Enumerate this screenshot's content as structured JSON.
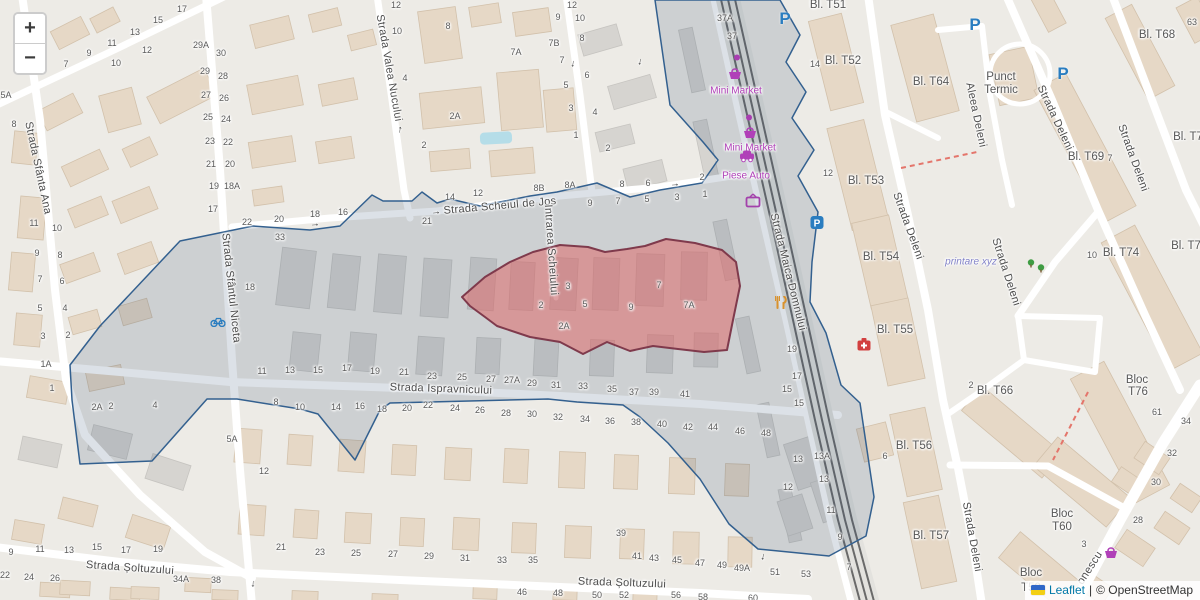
{
  "app": {
    "title": "Leaflet map with highlighted area"
  },
  "controls": {
    "zoom_in": "+",
    "zoom_out": "−"
  },
  "attribution": {
    "flag": "ukraine-flag-icon",
    "leaflet": "Leaflet",
    "separator": "|",
    "copyright": "© OpenStreetMap"
  },
  "colors": {
    "land": "#edebe6",
    "building": "#e6d8c6",
    "building_stroke": "#d2c1ab",
    "building_gray": "#d6d4d0",
    "road": "#ffffff",
    "rail": "#6a6a6a",
    "water": "#b5dde8",
    "parking_blue": "#2a7dc0",
    "poi_purple": "#b040b8",
    "restaurant_orange": "#d9922e",
    "firstaid_red": "#d23f3f",
    "tree_green": "#3f9c43",
    "selected_stroke": "#33608f",
    "selected_fill": "rgba(45,75,115,0.17)",
    "highlight_stroke": "#7f3a4c",
    "highlight_fill": "rgba(222,105,105,0.55)",
    "dashed_path": "#e4756b"
  },
  "street_labels": [
    {
      "t": "Strada Sfânta Ana",
      "x": 38,
      "y": 168,
      "r": 78
    },
    {
      "t": "Strada Valea Nucului",
      "x": 389,
      "y": 68,
      "r": 80
    },
    {
      "t": "Strada Sfântul Niceta",
      "x": 231,
      "y": 288,
      "r": 84
    },
    {
      "t": "Strada Scheiul de Jos",
      "x": 500,
      "y": 206,
      "r": -5
    },
    {
      "t": "Intrarea Scheiului",
      "x": 551,
      "y": 250,
      "r": 86
    },
    {
      "t": "Strada Ispravnicului",
      "x": 441,
      "y": 389,
      "r": 2
    },
    {
      "t": "Strada Șoltuzului",
      "x": 130,
      "y": 568,
      "r": 4
    },
    {
      "t": "Strada Șoltuzului",
      "x": 622,
      "y": 583,
      "r": 2
    },
    {
      "t": "Strada Maica Domnului",
      "x": 788,
      "y": 272,
      "r": 76
    },
    {
      "t": "Aleea Deleni",
      "x": 976,
      "y": 115,
      "r": 78
    },
    {
      "t": "Strada Deleni",
      "x": 1055,
      "y": 118,
      "r": 65
    },
    {
      "t": "Strada Deleni",
      "x": 1133,
      "y": 158,
      "r": 70
    },
    {
      "t": "Strada Deleni",
      "x": 908,
      "y": 226,
      "r": 70
    },
    {
      "t": "Strada Deleni",
      "x": 1006,
      "y": 272,
      "r": 72
    },
    {
      "t": "Strada Deleni",
      "x": 972,
      "y": 537,
      "r": 80
    },
    {
      "t": "onescu",
      "x": 1090,
      "y": 568,
      "r": -57
    }
  ],
  "building_labels": [
    {
      "t": "Bl. T51",
      "x": 828,
      "y": 5
    },
    {
      "t": "Bl. T52",
      "x": 843,
      "y": 61
    },
    {
      "t": "Bl. T53",
      "x": 866,
      "y": 181
    },
    {
      "t": "Bl. T54",
      "x": 881,
      "y": 257
    },
    {
      "t": "Bl. T55",
      "x": 895,
      "y": 330
    },
    {
      "t": "Bl. T56",
      "x": 914,
      "y": 446
    },
    {
      "t": "Bl. T57",
      "x": 931,
      "y": 536
    },
    {
      "t": "Bl. T64",
      "x": 931,
      "y": 82
    },
    {
      "t": "Bl. T66",
      "x": 995,
      "y": 391
    },
    {
      "t": "Bl. T68",
      "x": 1157,
      "y": 35
    },
    {
      "t": "Bl. T69",
      "x": 1086,
      "y": 157
    },
    {
      "t": "Bl. T74",
      "x": 1121,
      "y": 253
    },
    {
      "t": "Bl. T7",
      "x": 1188,
      "y": 137
    },
    {
      "t": "Bl. T7",
      "x": 1186,
      "y": 246
    },
    {
      "t": "Bloc",
      "x": 1137,
      "y": 380
    },
    {
      "t": "T76",
      "x": 1138,
      "y": 392
    },
    {
      "t": "Bloc",
      "x": 1062,
      "y": 514
    },
    {
      "t": "T60",
      "x": 1062,
      "y": 527
    },
    {
      "t": "Bloc",
      "x": 1031,
      "y": 573
    },
    {
      "t": "T59",
      "x": 1031,
      "y": 588
    },
    {
      "t": "Punct",
      "x": 1001,
      "y": 77
    },
    {
      "t": "Termic",
      "x": 1001,
      "y": 90
    }
  ],
  "poi_labels": [
    {
      "t": "Mini Market",
      "x": 736,
      "y": 91,
      "c": "poi-lbl"
    },
    {
      "t": "Mini Market",
      "x": 750,
      "y": 148,
      "c": "poi-lbl"
    },
    {
      "t": "Piese Auto",
      "x": 746,
      "y": 176,
      "c": "poi-lbl"
    },
    {
      "t": "printare xyz",
      "x": 971,
      "y": 262,
      "c": "shop-lbl"
    }
  ],
  "house_numbers": [
    [
      "7",
      66,
      64
    ],
    [
      "9",
      89,
      53
    ],
    [
      "10",
      116,
      63
    ],
    [
      "11",
      112,
      43
    ],
    [
      "12",
      147,
      50
    ],
    [
      "13",
      135,
      32
    ],
    [
      "15",
      158,
      20
    ],
    [
      "17",
      182,
      9
    ],
    [
      "5A",
      6,
      95
    ],
    [
      "8",
      14,
      124
    ],
    [
      "11",
      34,
      223
    ],
    [
      "10",
      57,
      228
    ],
    [
      "9",
      37,
      253
    ],
    [
      "8",
      60,
      255
    ],
    [
      "7",
      40,
      279
    ],
    [
      "6",
      62,
      281
    ],
    [
      "5",
      40,
      308
    ],
    [
      "4",
      65,
      308
    ],
    [
      "3",
      43,
      336
    ],
    [
      "2",
      68,
      335
    ],
    [
      "1A",
      46,
      364
    ],
    [
      "1",
      52,
      388
    ],
    [
      "29A",
      201,
      45
    ],
    [
      "30",
      221,
      53
    ],
    [
      "29",
      205,
      71
    ],
    [
      "28",
      223,
      76
    ],
    [
      "27",
      206,
      95
    ],
    [
      "26",
      224,
      98
    ],
    [
      "25",
      208,
      117
    ],
    [
      "24",
      226,
      119
    ],
    [
      "23",
      210,
      141
    ],
    [
      "22",
      228,
      142
    ],
    [
      "21",
      211,
      164
    ],
    [
      "20",
      230,
      164
    ],
    [
      "19",
      214,
      186
    ],
    [
      "18A",
      232,
      186
    ],
    [
      "17",
      213,
      209
    ],
    [
      "22",
      247,
      222
    ],
    [
      "20",
      279,
      219
    ],
    [
      "18",
      315,
      214
    ],
    [
      "16",
      343,
      212
    ],
    [
      "33",
      280,
      237
    ],
    [
      "18",
      250,
      287
    ],
    [
      "12",
      396,
      5
    ],
    [
      "10",
      397,
      31
    ],
    [
      "8",
      448,
      26
    ],
    [
      "4",
      405,
      78
    ],
    [
      "2A",
      455,
      116
    ],
    [
      "2",
      424,
      145
    ],
    [
      "7A",
      516,
      52
    ],
    [
      "7B",
      554,
      43
    ],
    [
      "9",
      558,
      17
    ],
    [
      "12",
      572,
      5
    ],
    [
      "10",
      580,
      18
    ],
    [
      "8",
      582,
      38
    ],
    [
      "7",
      562,
      60
    ],
    [
      "6",
      587,
      75
    ],
    [
      "5",
      566,
      85
    ],
    [
      "4",
      595,
      112
    ],
    [
      "3",
      571,
      108
    ],
    [
      "1",
      576,
      135
    ],
    [
      "2",
      608,
      148
    ],
    [
      "8",
      622,
      184
    ],
    [
      "6",
      648,
      183
    ],
    [
      "2",
      702,
      177
    ],
    [
      "37A",
      725,
      18
    ],
    [
      "37",
      732,
      36
    ],
    [
      "14",
      815,
      64
    ],
    [
      "12",
      828,
      173
    ],
    [
      "19",
      792,
      349
    ],
    [
      "17",
      797,
      376
    ],
    [
      "15",
      787,
      389
    ],
    [
      "14",
      450,
      197
    ],
    [
      "12",
      478,
      193
    ],
    [
      "8B",
      539,
      188
    ],
    [
      "8A",
      570,
      185
    ],
    [
      "9",
      590,
      203
    ],
    [
      "7",
      618,
      201
    ],
    [
      "5",
      647,
      199
    ],
    [
      "3",
      677,
      197
    ],
    [
      "1",
      705,
      194
    ],
    [
      "21",
      427,
      221
    ],
    [
      "3",
      568,
      286
    ],
    [
      "2",
      541,
      305
    ],
    [
      "2A",
      564,
      326
    ],
    [
      "5",
      585,
      304
    ],
    [
      "9",
      631,
      307
    ],
    [
      "7",
      659,
      285
    ],
    [
      "7A",
      689,
      305
    ],
    [
      "11",
      262,
      371
    ],
    [
      "13",
      290,
      370
    ],
    [
      "15",
      318,
      370
    ],
    [
      "17",
      347,
      368
    ],
    [
      "19",
      375,
      371
    ],
    [
      "21",
      404,
      372
    ],
    [
      "23",
      432,
      376
    ],
    [
      "25",
      462,
      377
    ],
    [
      "27",
      491,
      379
    ],
    [
      "27A",
      512,
      380
    ],
    [
      "29",
      532,
      383
    ],
    [
      "31",
      556,
      385
    ],
    [
      "33",
      583,
      386
    ],
    [
      "35",
      612,
      389
    ],
    [
      "37",
      634,
      392
    ],
    [
      "39",
      654,
      392
    ],
    [
      "41",
      685,
      394
    ],
    [
      "8",
      276,
      402
    ],
    [
      "10",
      300,
      407
    ],
    [
      "14",
      336,
      407
    ],
    [
      "16",
      360,
      406
    ],
    [
      "18",
      382,
      409
    ],
    [
      "20",
      407,
      408
    ],
    [
      "22",
      428,
      405
    ],
    [
      "24",
      455,
      408
    ],
    [
      "26",
      480,
      410
    ],
    [
      "28",
      506,
      413
    ],
    [
      "30",
      532,
      414
    ],
    [
      "32",
      558,
      417
    ],
    [
      "34",
      585,
      419
    ],
    [
      "36",
      610,
      421
    ],
    [
      "38",
      636,
      422
    ],
    [
      "40",
      662,
      424
    ],
    [
      "42",
      688,
      427
    ],
    [
      "44",
      713,
      427
    ],
    [
      "46",
      740,
      431
    ],
    [
      "48",
      766,
      433
    ],
    [
      "2A",
      97,
      407
    ],
    [
      "2",
      111,
      406
    ],
    [
      "4",
      155,
      405
    ],
    [
      "5A",
      232,
      439
    ],
    [
      "12",
      264,
      471
    ],
    [
      "9",
      11,
      552
    ],
    [
      "11",
      40,
      549
    ],
    [
      "13",
      69,
      550
    ],
    [
      "15",
      97,
      547
    ],
    [
      "17",
      126,
      550
    ],
    [
      "19",
      158,
      549
    ],
    [
      "21",
      281,
      547
    ],
    [
      "23",
      320,
      552
    ],
    [
      "25",
      356,
      553
    ],
    [
      "27",
      393,
      554
    ],
    [
      "29",
      429,
      556
    ],
    [
      "31",
      465,
      558
    ],
    [
      "33",
      502,
      560
    ],
    [
      "35",
      533,
      560
    ],
    [
      "39",
      621,
      533
    ],
    [
      "41",
      637,
      556
    ],
    [
      "43",
      654,
      558
    ],
    [
      "45",
      677,
      560
    ],
    [
      "47",
      700,
      563
    ],
    [
      "49",
      722,
      565
    ],
    [
      "49A",
      742,
      568
    ],
    [
      "51",
      775,
      572
    ],
    [
      "53",
      806,
      574
    ],
    [
      "22",
      5,
      575
    ],
    [
      "24",
      29,
      577
    ],
    [
      "26",
      55,
      578
    ],
    [
      "34A",
      181,
      579
    ],
    [
      "38",
      216,
      580
    ],
    [
      "46",
      522,
      592
    ],
    [
      "48",
      558,
      593
    ],
    [
      "50",
      597,
      595
    ],
    [
      "52",
      624,
      595
    ],
    [
      "56",
      676,
      595
    ],
    [
      "58",
      703,
      597
    ],
    [
      "60",
      753,
      598
    ],
    [
      "13",
      798,
      459
    ],
    [
      "13A",
      822,
      456
    ],
    [
      "13",
      824,
      479
    ],
    [
      "12",
      788,
      487
    ],
    [
      "11",
      831,
      510
    ],
    [
      "9",
      840,
      537
    ],
    [
      "7",
      849,
      567
    ],
    [
      "15",
      799,
      403
    ],
    [
      "6",
      885,
      456
    ],
    [
      "63",
      1192,
      22
    ],
    [
      "7",
      1110,
      158
    ],
    [
      "10",
      1092,
      255
    ],
    [
      "2",
      971,
      385
    ],
    [
      "61",
      1157,
      412
    ],
    [
      "34",
      1186,
      421
    ],
    [
      "32",
      1172,
      453
    ],
    [
      "30",
      1156,
      482
    ],
    [
      "28",
      1138,
      520
    ],
    [
      "3",
      1084,
      544
    ]
  ],
  "icons": [
    {
      "type": "parking-icon",
      "x": 785,
      "y": 19
    },
    {
      "type": "parking-icon",
      "x": 975,
      "y": 25
    },
    {
      "type": "parking-icon",
      "x": 1063,
      "y": 74
    },
    {
      "type": "parking-box-icon",
      "x": 817,
      "y": 225
    },
    {
      "type": "shop-dot-icon",
      "x": 737,
      "y": 57
    },
    {
      "type": "shop-dot-icon",
      "x": 749,
      "y": 117
    },
    {
      "type": "basket-icon",
      "x": 735,
      "y": 76
    },
    {
      "type": "basket-icon",
      "x": 750,
      "y": 135
    },
    {
      "type": "basket-icon",
      "x": 1111,
      "y": 555
    },
    {
      "type": "car-icon",
      "x": 747,
      "y": 158
    },
    {
      "type": "tv-icon",
      "x": 753,
      "y": 203
    },
    {
      "type": "restaurant-icon",
      "x": 781,
      "y": 305
    },
    {
      "type": "firstaid-icon",
      "x": 864,
      "y": 347
    },
    {
      "type": "bicycle-icon",
      "x": 218,
      "y": 323
    },
    {
      "type": "tree-icon",
      "x": 1031,
      "y": 264
    },
    {
      "type": "tree-icon",
      "x": 1041,
      "y": 269
    }
  ],
  "arrows": [
    {
      "t": "→",
      "x": 315,
      "y": 224,
      "r": -4
    },
    {
      "t": "→",
      "x": 436,
      "y": 212,
      "r": -5
    },
    {
      "t": "→",
      "x": 675,
      "y": 184,
      "r": -4
    },
    {
      "t": "↓",
      "x": 573,
      "y": 64,
      "r": 8
    },
    {
      "t": "↓",
      "x": 640,
      "y": 62,
      "r": 10
    },
    {
      "t": "↑",
      "x": 400,
      "y": 130,
      "r": 8
    },
    {
      "t": "↓",
      "x": 253,
      "y": 584,
      "r": 4
    },
    {
      "t": "↓",
      "x": 763,
      "y": 557,
      "r": 10
    }
  ]
}
